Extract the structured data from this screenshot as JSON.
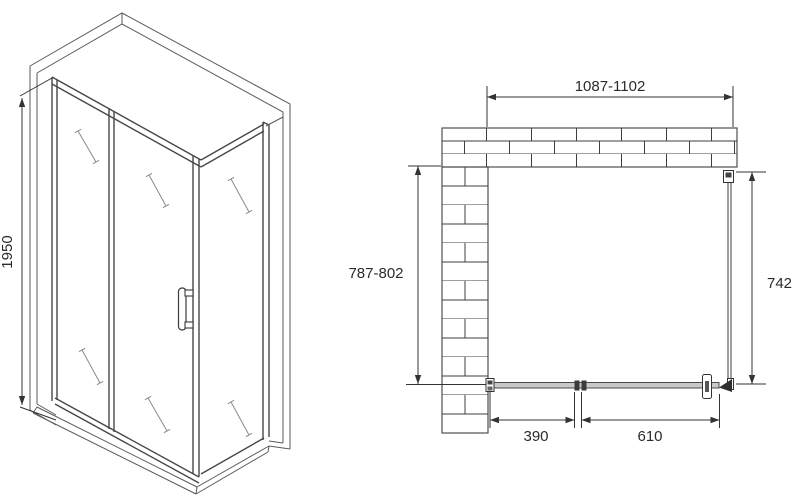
{
  "drawing": {
    "dims": {
      "height": "1950",
      "width": "1087-1102",
      "depth": "787-802",
      "side": "742",
      "door": "390",
      "fixed": "610"
    },
    "colors": {
      "line": "#3f3f3f",
      "track_fill": "#c9c9c9",
      "background": "#ffffff"
    }
  }
}
